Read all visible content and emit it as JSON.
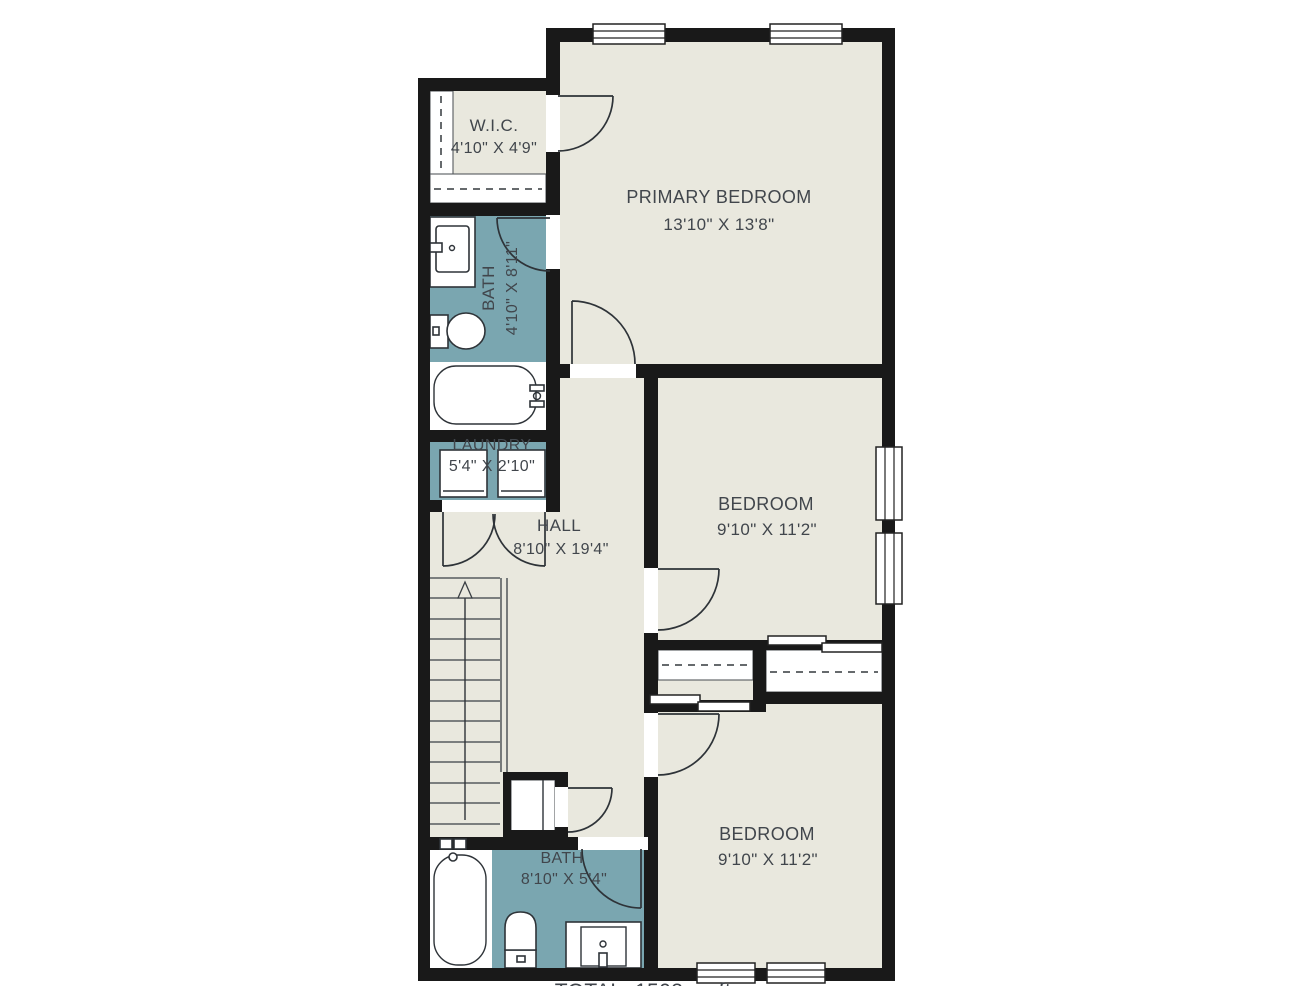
{
  "palette": {
    "floor": "#e9e8de",
    "wet_room": "#7aa6b0",
    "wall": "#191919",
    "line": "#2e3338",
    "text": "#41464c",
    "background": "#ffffff"
  },
  "rooms": {
    "wic": {
      "label": "W.I.C.",
      "dims": "4'10\" X 4'9\""
    },
    "bath_upper": {
      "label": "BATH",
      "dims": "4'10\" X 8'11\""
    },
    "laundry": {
      "label": "LAUNDRY",
      "dims": "5'4\" X 2'10\""
    },
    "hall": {
      "label": "HALL",
      "dims": "8'10\" X 19'4\""
    },
    "primary_bedroom": {
      "label": "PRIMARY BEDROOM",
      "dims": "13'10\" X 13'8\""
    },
    "bedroom_middle": {
      "label": "BEDROOM",
      "dims": "9'10\" X 11'2\""
    },
    "bedroom_lower": {
      "label": "BEDROOM",
      "dims": "9'10\" X 11'2\""
    },
    "bath_lower": {
      "label": "BATH",
      "dims": "8'10\" X 5'4\""
    }
  },
  "footer": {
    "total_label": "TOTAL: 1503 sq ft"
  }
}
